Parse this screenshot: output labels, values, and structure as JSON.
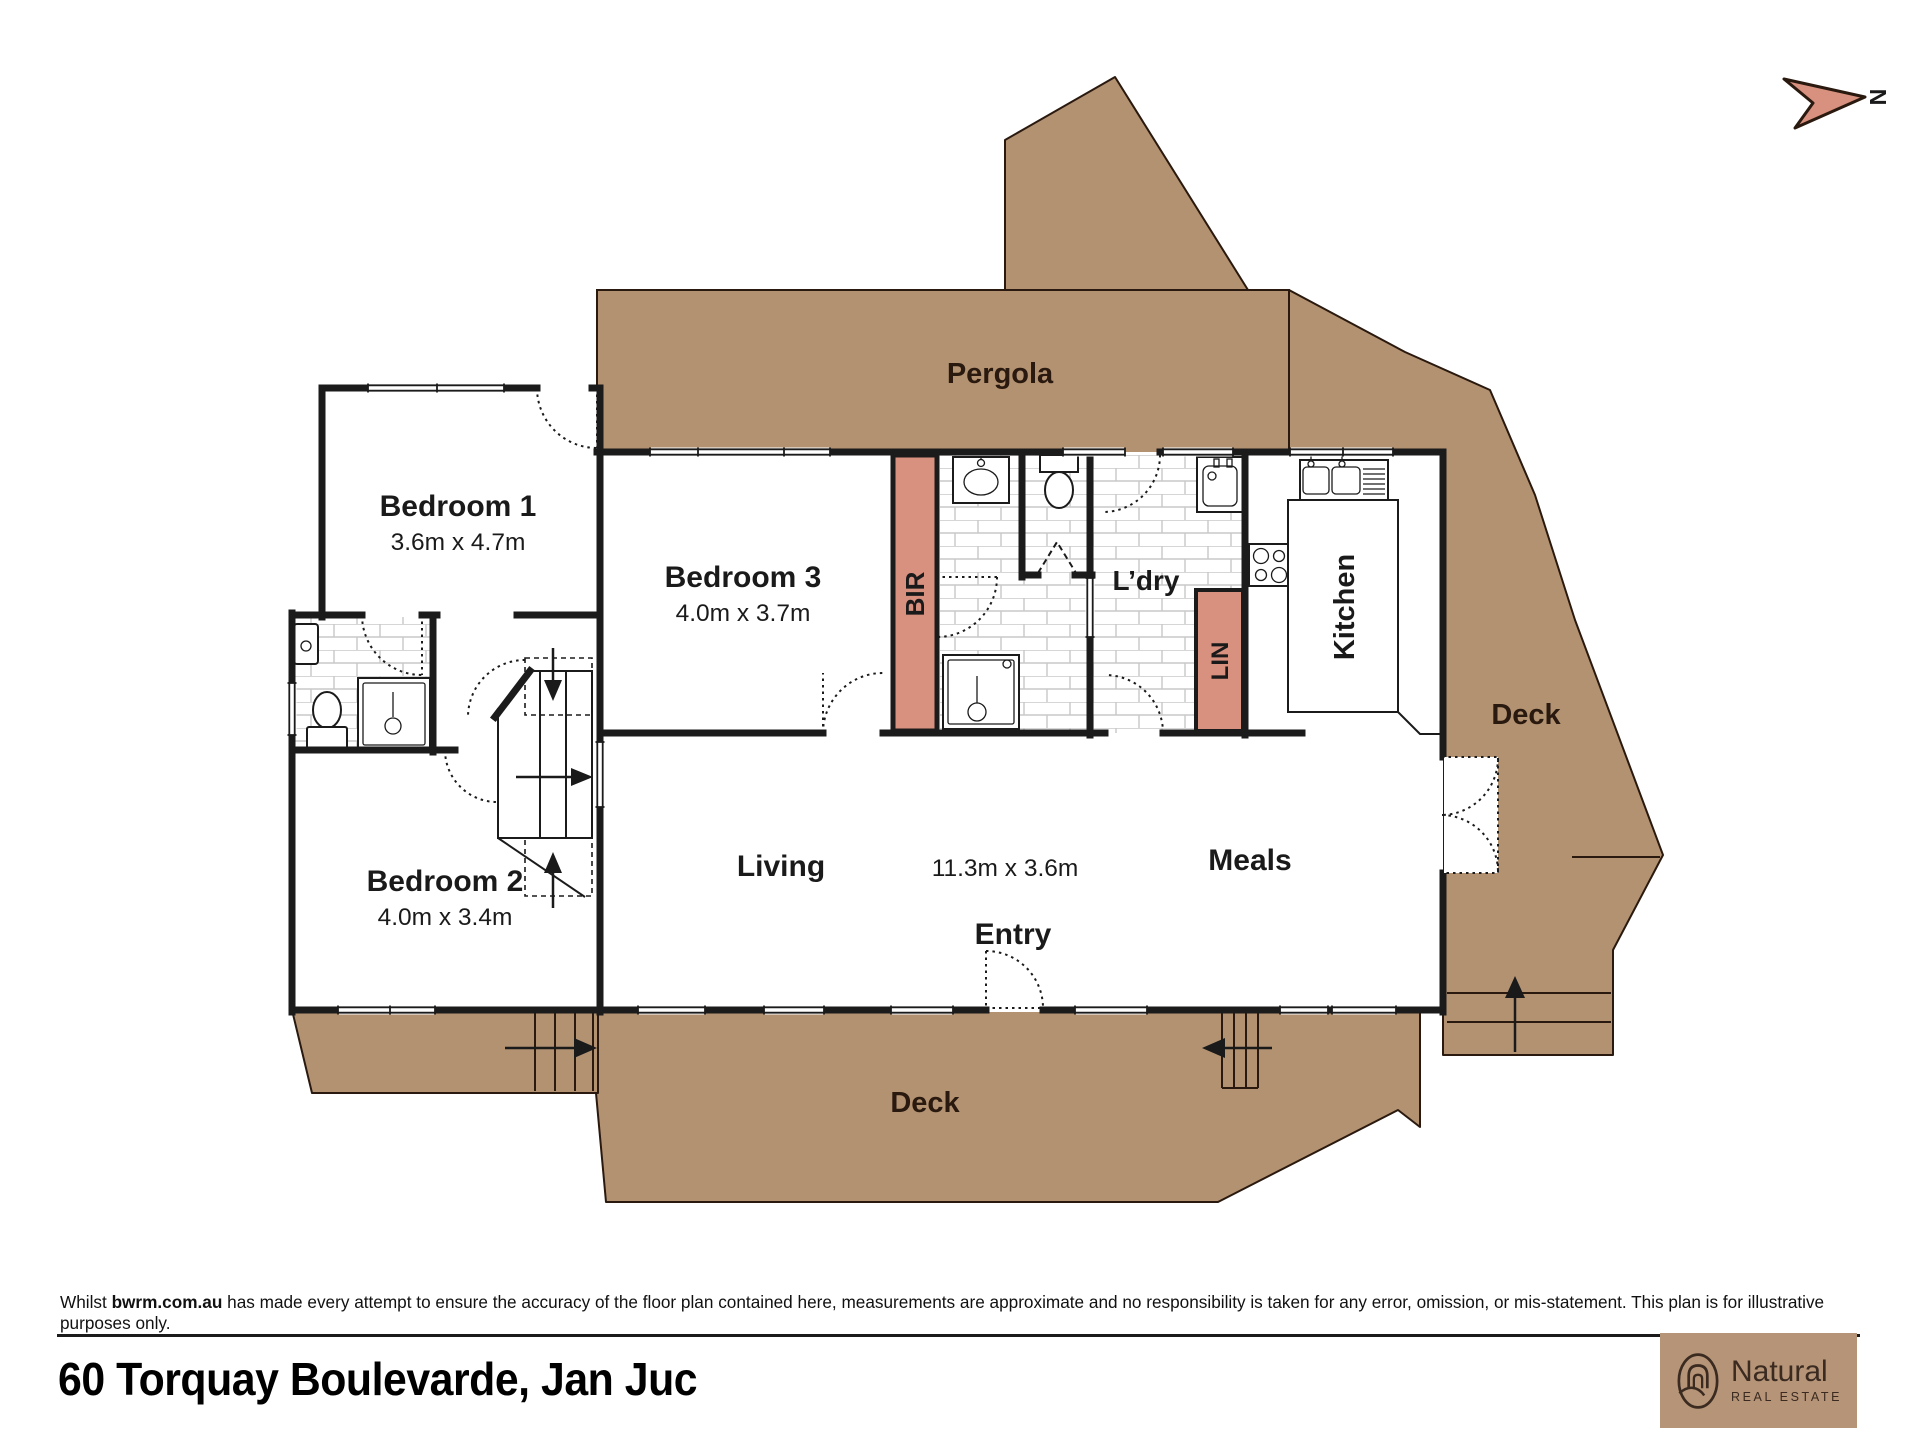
{
  "north": {
    "letter": "N"
  },
  "plan": {
    "labels": {
      "pergola": "Pergola",
      "bedroom1": "Bedroom 1",
      "bedroom1_dim": "3.6m x 4.7m",
      "bedroom2": "Bedroom 2",
      "bedroom2_dim": "4.0m x 3.4m",
      "bedroom3": "Bedroom 3",
      "bedroom3_dim": "4.0m x 3.7m",
      "bir": "BIR",
      "ldry": "L’dry",
      "lin": "LIN",
      "kitchen": "Kitchen",
      "living": "Living",
      "living_dim": "11.3m x 3.6m",
      "meals": "Meals",
      "entry": "Entry",
      "deck_right": "Deck",
      "deck_bottom": "Deck"
    },
    "colors": {
      "deck": "#b39272",
      "deck_outline": "#2a190e",
      "wardrobe": "#d8907f",
      "wall": "#1b1b1b"
    }
  },
  "footer": {
    "disclaimer_prefix": "Whilst ",
    "disclaimer_bold": "bwrm.com.au",
    "disclaimer_rest": " has made every attempt to ensure the accuracy of the floor plan contained here, measurements are approximate and no responsibility is taken for any error, omission, or mis-statement. This plan is for illustrative purposes only.",
    "address": "60 Torquay Boulevarde, Jan Juc"
  },
  "logo": {
    "brand": "Natural",
    "tagline": "REAL ESTATE",
    "bg": "#b59478",
    "fg": "#3a2a20"
  }
}
